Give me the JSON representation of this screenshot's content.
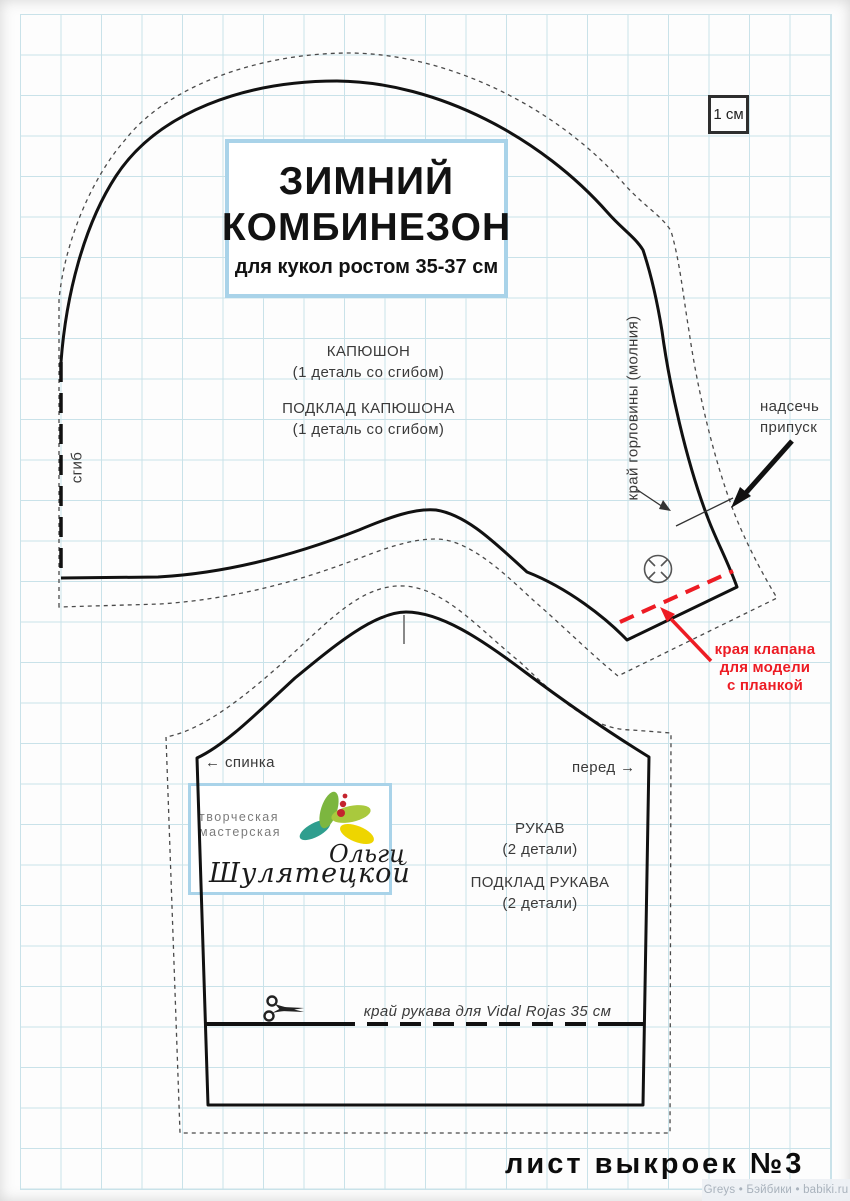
{
  "page": {
    "sheet_label": "лист выкроек №3",
    "watermark": "Greys • Бэйбики • babiki.ru"
  },
  "scale_box": {
    "label": "1 см"
  },
  "title_box": {
    "line1": "ЗИМНИЙ",
    "line2": "КОМБИНЕЗОН",
    "subtitle": "для кукол ростом 35-37 см"
  },
  "hood": {
    "piece_label": "КАПЮШОН",
    "piece_note": "(1 деталь со сгибом)",
    "lining_label": "ПОДКЛАД КАПЮШОНА",
    "lining_note": "(1 деталь со сгибом)",
    "fold_label": "сгиб",
    "neckline_label": "край горловины (молния)",
    "notch_line1": "надсечь",
    "notch_line2": "припуск",
    "flap_line1": "края клапана",
    "flap_line2": "для модели",
    "flap_line3": "с планкой"
  },
  "sleeve": {
    "back_arrow": "←",
    "back_label": "спинка",
    "front_label": "перед",
    "front_arrow": "→",
    "piece_label": "РУКАВ",
    "piece_note": "(2 детали)",
    "lining_label": "ПОДКЛАД РУКАВА",
    "lining_note": "(2 детали)",
    "cut_label": "край рукава для Vidal Rojas 35 см"
  },
  "logo": {
    "studio_line1": "творческая",
    "studio_line2": "мастерская",
    "name_part1": "Ольги",
    "name_part2": "Шулятецкой"
  },
  "colors": {
    "accent_red": "#ed1c24",
    "grid_line": "#c9e2e9",
    "box_border": "#a9d3e9",
    "ink": "#111111"
  }
}
